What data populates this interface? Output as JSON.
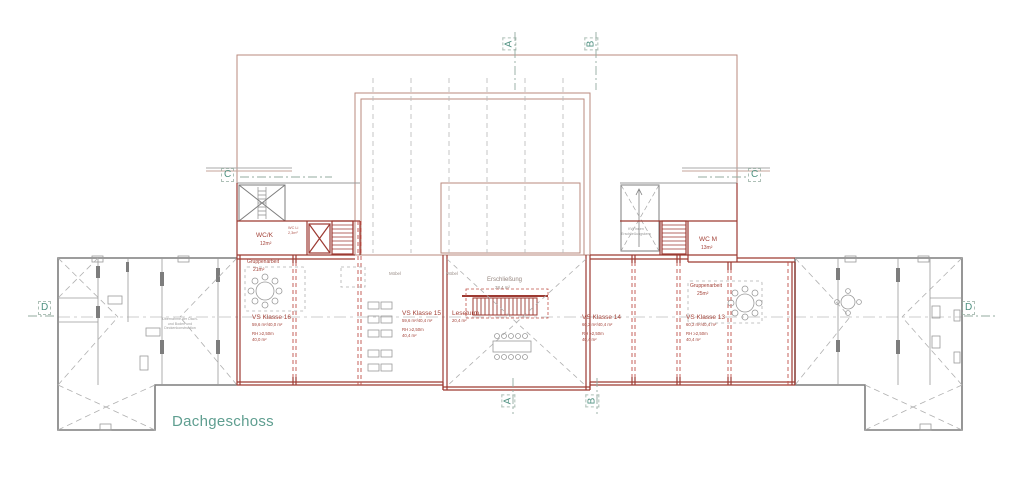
{
  "drawing": {
    "title": "Dachgeschoss",
    "markers": {
      "top_a": "A",
      "top_b": "B",
      "bottom_a": "A",
      "bottom_b": "B",
      "left_c": "C",
      "right_c": "C",
      "left_d": "D",
      "right_d": "D"
    },
    "core_left": {
      "wc_label": "WC/K",
      "wc_area": "12m²",
      "wc_li_label": "WC Li",
      "wc_li_area": "2,3m²"
    },
    "core_right": {
      "wc_label": "WC M",
      "wc_area": "13m²",
      "note_line1": "KW Innen",
      "note_line2": "Erschließungskern"
    },
    "group_left": {
      "label": "Gruppenarbeit",
      "area": "21m²"
    },
    "group_right": {
      "label": "Gruppenarbeit",
      "area": "25m²"
    },
    "rooms": {
      "k16": {
        "name": "VS Klasse 16",
        "areas": "59,6 m²/40,0 m²",
        "rh": "RH ≥2,50m",
        "area2": "40,0 m²"
      },
      "k15": {
        "name": "VS Klasse 15",
        "areas": "59,6 m²/40,4 m²",
        "rh": "RH ≥2,50m",
        "area2": "40,4 m²"
      },
      "k14": {
        "name": "VS Klasse 14",
        "areas": "60,2 m²/40,4 m²",
        "rh": "RH ≥2,50m",
        "area2": "40,4 m²"
      },
      "k13": {
        "name": "VS Klasse 13",
        "areas": "60,2 m²/40,4 m²",
        "rh": "RH ≥2,50m",
        "area2": "40,4 m²"
      },
      "leseturm": {
        "name": "Leseturm",
        "area": "20,4 m²"
      },
      "erschliessung": {
        "name": "Erschließung",
        "area": "38,4 m²"
      }
    },
    "furniture_labels": {
      "moebel1": "Möbel",
      "moebel2": "Möbel"
    },
    "wing_note": [
      "Übernahme der Dach-",
      "und Boden und",
      "Deckenkonstruktion"
    ],
    "colors": {
      "wall_red": "#9d3a32",
      "roof_brown": "#b98a7e",
      "wall_gray": "#7d7d7d",
      "marker_green": "#4f9181",
      "title_green": "#5f9e90",
      "text_red": "#a34238",
      "text_gray": "#9a9a9a"
    }
  }
}
